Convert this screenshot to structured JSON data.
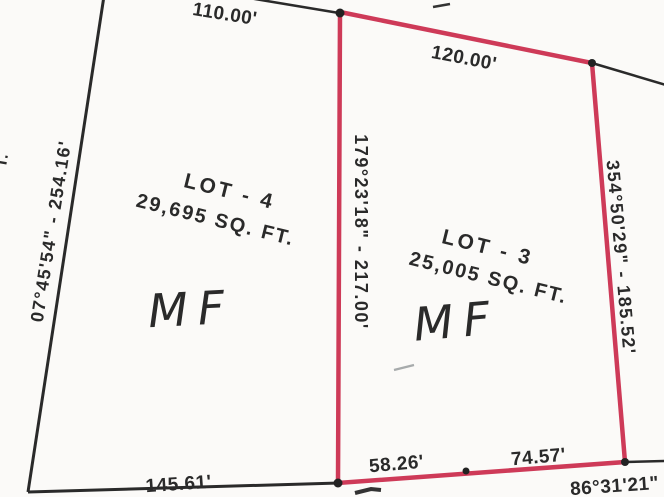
{
  "palette": {
    "paper": "#fbfaf8",
    "ink": "#2a2a2a",
    "parcel_red": "#ce3a58",
    "pencil_light": "#a0a4a6",
    "pencil_dark": "#5f6366"
  },
  "lots": {
    "lot4": {
      "name": "LOT - 4",
      "area": "29,695 SQ. FT.",
      "handwritten": "MF"
    },
    "lot3": {
      "name": "LOT - 3",
      "area": "25,005 SQ. FT.",
      "handwritten": "MF"
    }
  },
  "dimensions": {
    "top_left_length": "110.00'",
    "top_right_length": "120.00'",
    "left_bearing": "07°45'54\" - 254.16'",
    "center_bearing": "179°23'18\" - 217.00'",
    "right_bearing": "354°50'29\" - 185.52'",
    "bottom_left_length": "145.61'",
    "bottom_segment_left": "58.26'",
    "bottom_segment_right": "74.57'",
    "bottom_right_bearing": "86°31'21\"",
    "street_label_partial": "T."
  }
}
